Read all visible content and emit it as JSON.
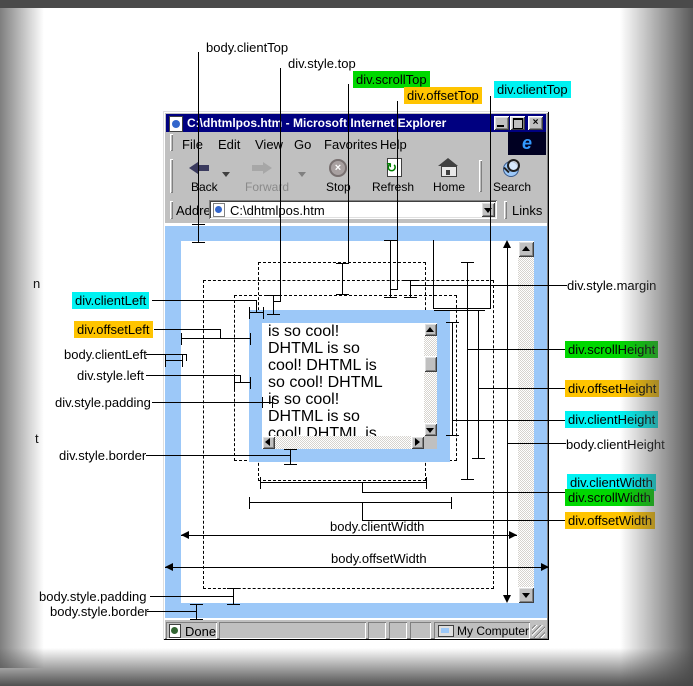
{
  "colors": {
    "cyan": "#00F2F2",
    "green": "#00D800",
    "orange": "#FFC400",
    "blue_border": "#9CC8F8",
    "title_bar": "#000080",
    "chrome": "#C0C0C0"
  },
  "browser": {
    "title": "C:\\dhtmlpos.htm - Microsoft Internet Explorer",
    "logo_letter": "e",
    "menu": {
      "file": "File",
      "edit": "Edit",
      "view": "View",
      "go": "Go",
      "favorites": "Favorites",
      "help": "Help"
    },
    "toolbar": {
      "back": "Back",
      "forward": "Forward",
      "stop": "Stop",
      "refresh": "Refresh",
      "home": "Home",
      "search": "Search"
    },
    "address": {
      "label": "Address",
      "value": "C:\\dhtmlpos.htm",
      "links": "Links"
    },
    "status": {
      "done": "Done",
      "my_computer": "My Computer"
    }
  },
  "content": {
    "div_lines": [
      "is so cool!",
      "DHTML is so",
      "cool! DHTML is",
      "so cool! DHTML",
      "is so cool!",
      "DHTML is so",
      "cool! DHTML is"
    ]
  },
  "annotations": {
    "body_clientTop": "body.clientTop",
    "div_style_top": "div.style.top",
    "div_scrollTop": "div.scrollTop",
    "div_offsetTop": "div.offsetTop",
    "div_clientTop": "div.clientTop",
    "div_clientLeft": "div.clientLeft",
    "div_offsetLeft": "div.offsetLeft",
    "body_clientLeft": "body.clientLeft",
    "div_style_left": "div.style.left",
    "div_style_padding": "div.style.padding",
    "div_style_border": "div.style.border",
    "body_style_padding": "body.style.padding",
    "body_style_border": "body.style.border",
    "div_style_margin": "div.style.margin",
    "div_scrollHeight": "div.scrollHeight",
    "div_offsetHeight": "div.offsetHeight",
    "div_clientHeight": "div.clientHeight",
    "body_clientHeight": "body.clientHeight",
    "div_clientWidth": "div.clientWidth",
    "div_scrollWidth": "div.scrollWidth",
    "div_offsetWidth": "div.offsetWidth",
    "body_clientWidth": "body.clientWidth",
    "body_offsetWidth": "body.offsetWidth",
    "fragment_n": "n",
    "fragment_t": "t"
  }
}
